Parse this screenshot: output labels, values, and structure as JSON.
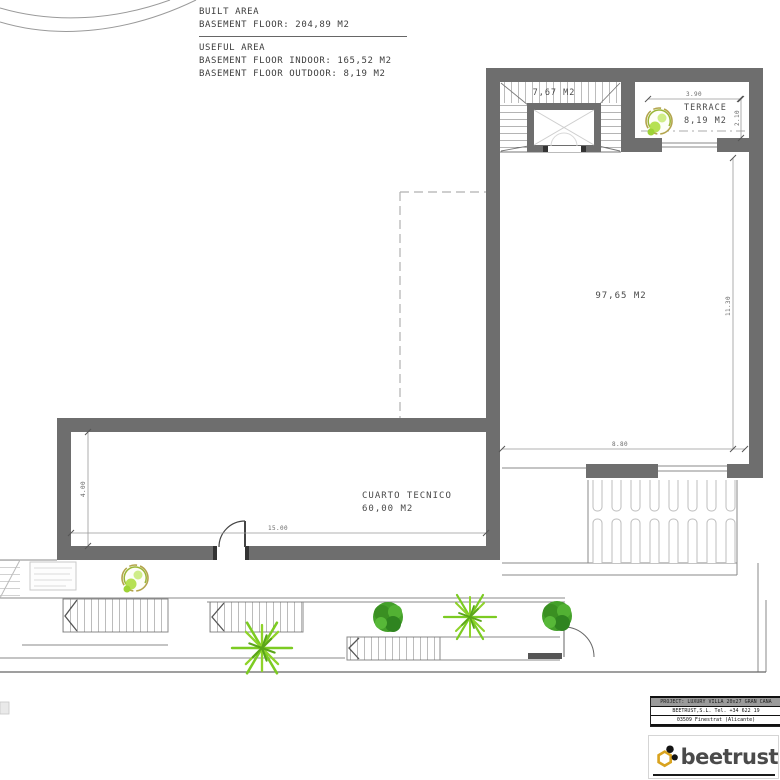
{
  "colors": {
    "wall": "#6e6e6e",
    "thin_line": "#8a8a8a",
    "lime_green": "#8fd32a",
    "dark_green": "#3f9b28",
    "logo_gold": "#d9a31f"
  },
  "header": {
    "built_title": "BUILT AREA",
    "built_line": "BASEMENT FLOOR: 204,89 M2",
    "useful_title": "USEFUL AREA",
    "useful_indoor": "BASEMENT FLOOR INDOOR: 165,52 M2",
    "useful_outdoor": "BASEMENT FLOOR OUTDOOR: 8,19 M2"
  },
  "plan": {
    "stairwell_area": "7,67 M2",
    "terrace_label": "TERRACE",
    "terrace_area": "8,19 M2",
    "main_room_area": "97,65 M2",
    "tech_room_label": "CUARTO TECNICO",
    "tech_room_area": "60,00 M2",
    "dimensions": {
      "terrace_width": "3.90",
      "terrace_depth": "2.10",
      "room_height": "11.30",
      "room_width": "8.80",
      "tech_depth": "4.00",
      "tech_width": "15.00"
    }
  },
  "titleblock": {
    "project_line": "PROJECT: LUXURY VILLA 20x27 GRAN CANA",
    "company_line": "BEETRUST,S.L.  Tel. +34 622 19",
    "address_line": "03509 Finestrat (Alicante)",
    "logo_text": "beetrust"
  }
}
